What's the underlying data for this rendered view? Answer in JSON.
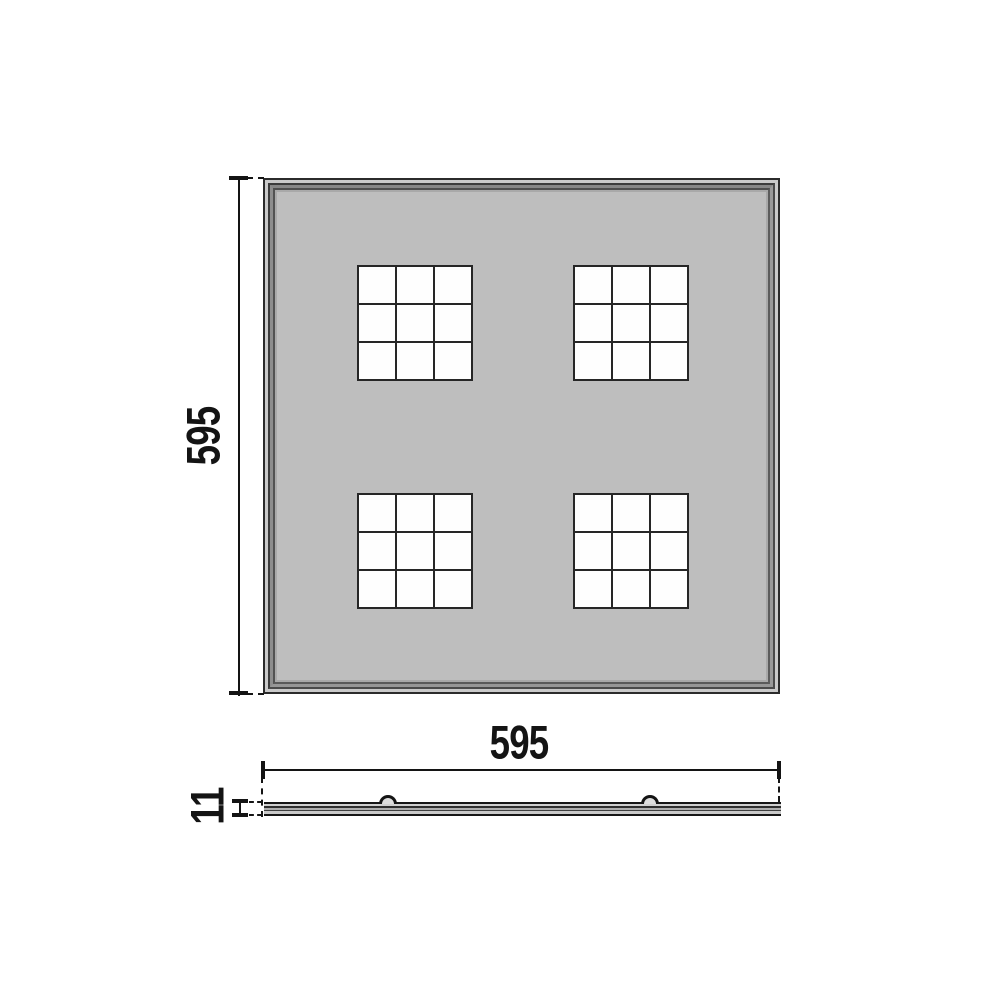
{
  "drawing": {
    "type": "technical-dimension-drawing",
    "plan_view": {
      "height_dimension": "595",
      "width_dimension": "595",
      "panel_face_color": "#bebebe",
      "module_count": 4,
      "module_grid": "3x3",
      "module_cell_color": "#fefefe"
    },
    "profile_view": {
      "thickness_dimension": "11",
      "clip_count": 2
    },
    "colors": {
      "line": "#141414",
      "frame_dark": "#2b2b2b",
      "frame_light_band": "#cacaca",
      "background": "#ffffff"
    }
  }
}
